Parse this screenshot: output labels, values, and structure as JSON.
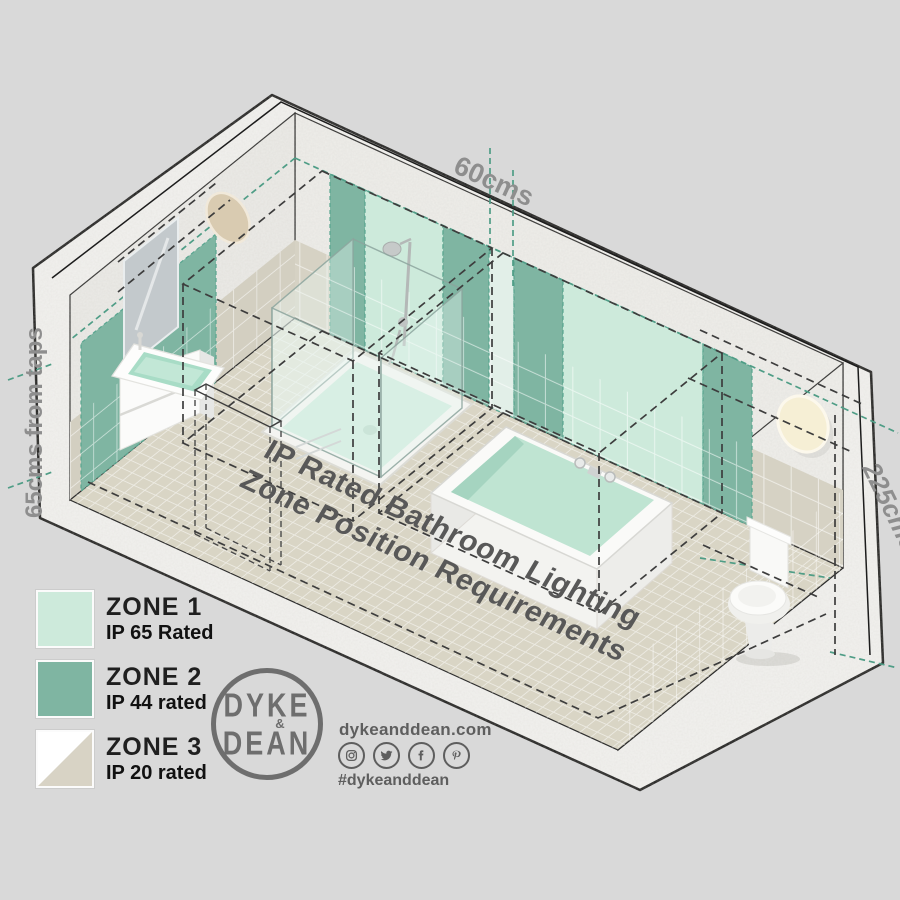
{
  "floor_title": {
    "line1": "IP Rated Bathroom Lighting",
    "line2": "Zone Position Requirements"
  },
  "dimensions": {
    "zone2_strip_width": "60cms",
    "from_taps": "65cms from taps",
    "zone_height": "225cms"
  },
  "legend": {
    "items": [
      {
        "zone": "ZONE 1",
        "rating": "IP 65 Rated",
        "swatch": "#cdeadb"
      },
      {
        "zone": "ZONE 2",
        "rating": "IP 44 rated",
        "swatch": "#7fb5a2"
      },
      {
        "zone": "ZONE 3",
        "rating": "IP 20 rated",
        "swatch": "#ffffff",
        "swatch_secondary": "#d8d3c5"
      }
    ]
  },
  "brand": {
    "logo_top": "DYKE",
    "logo_amp": "&",
    "logo_bottom": "DEAN",
    "website": "dykeanddean.com",
    "hashtag": "#dykeanddean",
    "social": [
      "instagram",
      "twitter",
      "facebook",
      "pinterest"
    ]
  },
  "colors": {
    "background": "#d9d9d9",
    "zone1_mint": "#cdeadb",
    "zone2_teal": "#7fb5a2",
    "zone3_beige": "#d8d3c5",
    "pale_panel": "#e2efe8",
    "teal_dash": "#4f9d86",
    "floor": "#d9d5c5",
    "wall_tile": "#d6d2c4",
    "plaster": "#efeeea"
  }
}
